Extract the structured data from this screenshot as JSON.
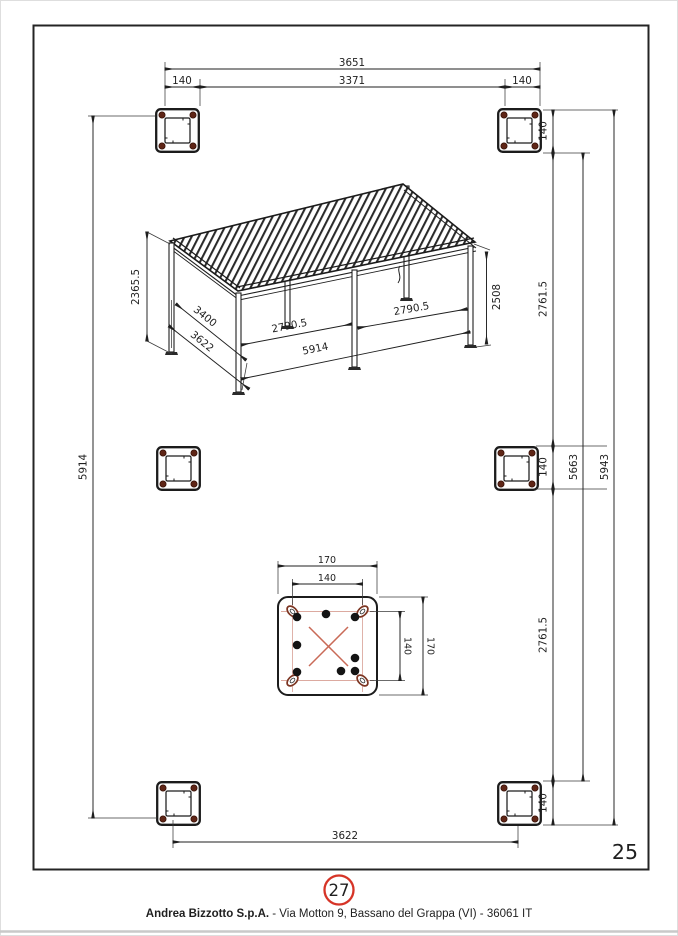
{
  "page": {
    "number": "25"
  },
  "callout": {
    "number": "27"
  },
  "footer": {
    "company": "Andrea Bizzotto S.p.A.",
    "address": " - Via Motton 9, Bassano del Grappa (VI) - 36061 IT"
  },
  "plan": {
    "top_total": "3651",
    "top_inner": "3371",
    "top_left_offset": "140",
    "top_right_offset": "140",
    "right_top_plate": "140",
    "right_upper_span": "2761.5",
    "right_mid_plate": "140",
    "right_lower_span": "2761.5",
    "right_bottom_plate": "140",
    "right_inner_total": "5663",
    "right_outer_total": "5943",
    "left_total": "5914",
    "bottom_span": "3622"
  },
  "pergola": {
    "height_back": "2365.5",
    "depth_inner": "3400",
    "depth_outer": "3622",
    "bay_front_left": "2790.5",
    "bay_front_right": "2790.5",
    "length_front": "5914",
    "height_front": "2508"
  },
  "plate_detail": {
    "width_outer": "170",
    "width_bolt_spacing": "140",
    "height_outer": "170",
    "height_bolt_spacing": "140"
  }
}
